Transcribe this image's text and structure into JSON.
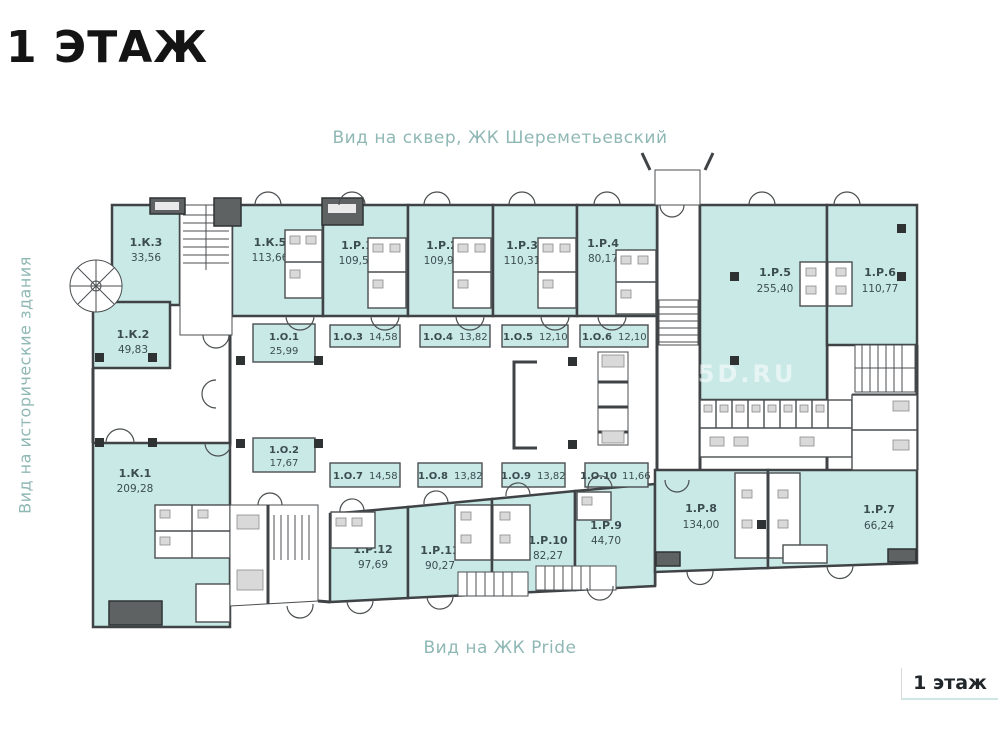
{
  "page": {
    "title": "1 ЭТАЖ",
    "floor_badge": "1 этаж",
    "watermark": "S5D.RU"
  },
  "views": {
    "top": "Вид на сквер, ЖК Шереметьевский",
    "left": "Вид на исторические здания",
    "bottom": "Вид на ЖК Pride"
  },
  "colors": {
    "room_fill": "#c8e9e6",
    "wall": "#3f4345",
    "unit_label": "#3c4d50",
    "view_label": "#8fb8b5",
    "badge_underline": "#cfe7e4"
  },
  "units": {
    "k3": {
      "name": "1.К.3",
      "area": "33,56"
    },
    "k5": {
      "name": "1.К.5",
      "area": "113,66"
    },
    "r1": {
      "name": "1.Р.1",
      "area": "109,50"
    },
    "r2": {
      "name": "1.Р.2",
      "area": "109,92"
    },
    "r3": {
      "name": "1.Р.3",
      "area": "110,31"
    },
    "r4": {
      "name": "1.Р.4",
      "area": "80,17"
    },
    "r5": {
      "name": "1.Р.5",
      "area": "255,40"
    },
    "r6": {
      "name": "1.Р.6",
      "area": "110,77"
    },
    "k2": {
      "name": "1.К.2",
      "area": "49,83"
    },
    "k1": {
      "name": "1.К.1",
      "area": "209,28"
    },
    "r12": {
      "name": "1.Р.12",
      "area": "97,69"
    },
    "r11": {
      "name": "1.Р.11",
      "area": "90,27"
    },
    "r10": {
      "name": "1.Р.10",
      "area": "82,27"
    },
    "r9": {
      "name": "1.Р.9",
      "area": "44,70"
    },
    "r8": {
      "name": "1.Р.8",
      "area": "134,00"
    },
    "r7": {
      "name": "1.Р.7",
      "area": "66,24"
    },
    "o1": {
      "name": "1.О.1",
      "area": "25,99"
    },
    "o2": {
      "name": "1.О.2",
      "area": "17,67"
    },
    "o3": {
      "name": "1.О.3",
      "area": "14,58"
    },
    "o4": {
      "name": "1.О.4",
      "area": "13,82"
    },
    "o5": {
      "name": "1.О.5",
      "area": "12,10"
    },
    "o6": {
      "name": "1.О.6",
      "area": "12,10"
    },
    "o7": {
      "name": "1.О.7",
      "area": "14,58"
    },
    "o8": {
      "name": "1.О.8",
      "area": "13,82"
    },
    "o9": {
      "name": "1.О.9",
      "area": "13,82"
    },
    "o10": {
      "name": "1.О.10",
      "area": "11,66"
    }
  }
}
